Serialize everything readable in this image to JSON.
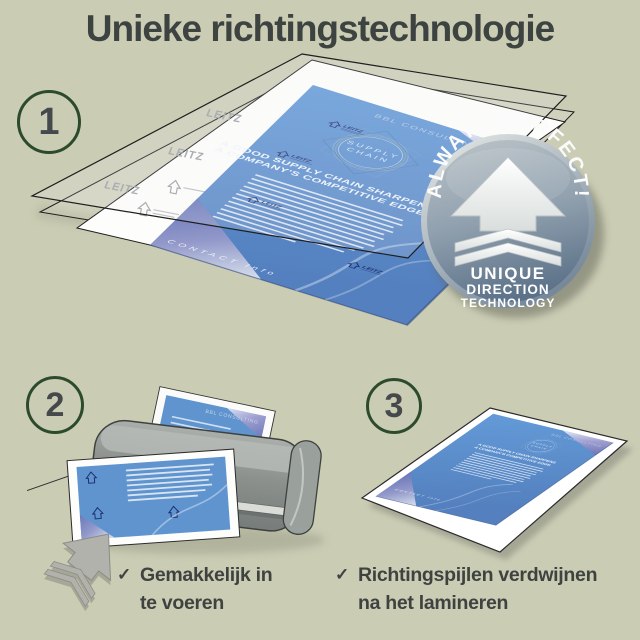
{
  "title": "Unieke richtingstechnologie",
  "check_glyph": "✓",
  "steps": [
    {
      "number": "1"
    },
    {
      "number": "2",
      "caption_line1": "Gemakkelijk in",
      "caption_line2": "te voeren"
    },
    {
      "number": "3",
      "caption_line1": "Richtingspijlen verdwijnen",
      "caption_line2": "na het lamineren"
    }
  ],
  "badge": {
    "arc_text": "ALWAYS PERFECT!",
    "line1": "UNIQUE",
    "line2": "DIRECTION",
    "line3": "TECHNOLOGY"
  },
  "brochure": {
    "brand": "BBL CONSULTING",
    "logo_line1": "SUPPLY",
    "logo_line2": "CHAIN",
    "headline_line1": "A GOOD SUPPLY CHAIN SHARPENS",
    "headline_line2": "A COMPANY'S COMPETITIVE EDGE.",
    "contact": "CONTACT Info",
    "watermark": "LEITZ"
  },
  "colors": {
    "background": "#cbccb4",
    "title_text": "#3c4340",
    "step_circle_border": "#2c4b2d",
    "step_number": "#45494c",
    "brochure_blue": "#5f93cf",
    "watermark_navy": "#1e2f6e",
    "badge_silver": "#8ea0af",
    "laminator_gray": "#8c918e"
  }
}
